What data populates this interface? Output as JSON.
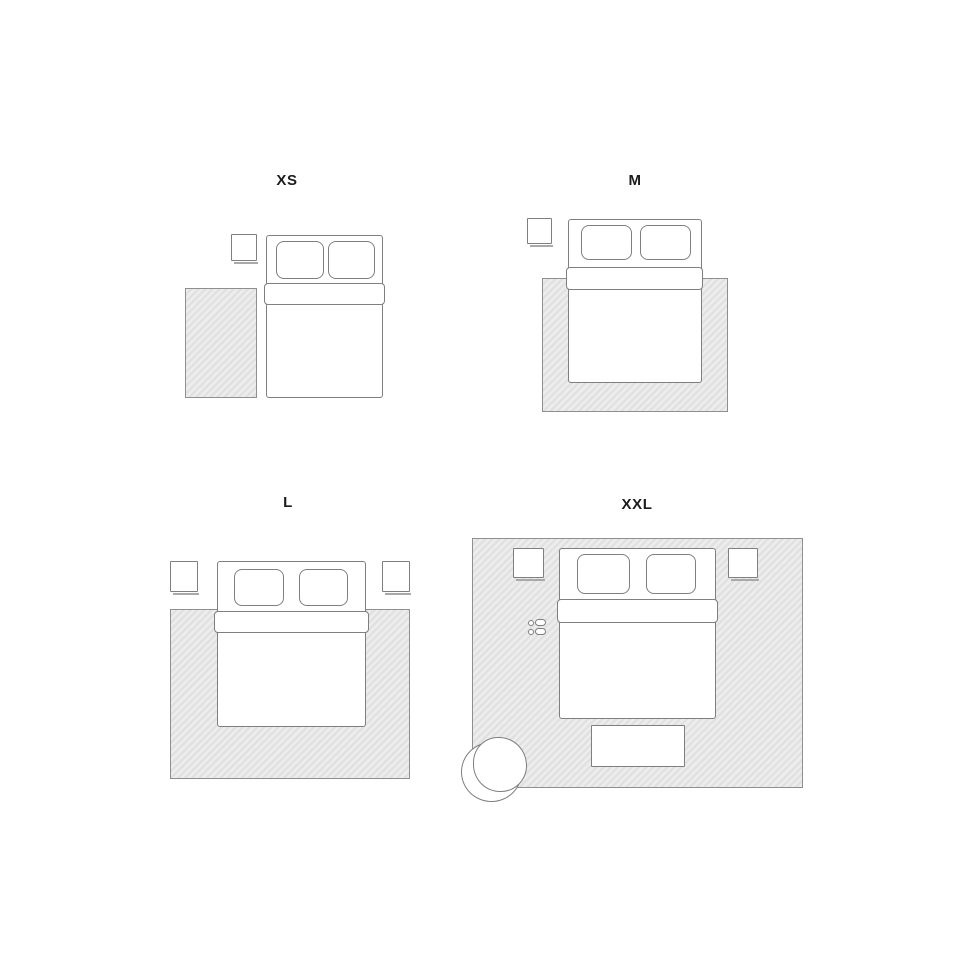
{
  "sizes": [
    {
      "id": "xs",
      "label": "XS"
    },
    {
      "id": "m",
      "label": "M"
    },
    {
      "id": "l",
      "label": "L"
    },
    {
      "id": "xxl",
      "label": "XXL"
    }
  ],
  "colors": {
    "background": "#ffffff",
    "label_text": "#1c1c1c",
    "furniture_outline": "#7f7f7f",
    "rug_fill_light": "#ededed",
    "rug_fill_dark": "#e1e1e1",
    "rug_border": "#8f8f8f"
  },
  "icons": {
    "bed": "bed-top-view",
    "pillow": "pillow",
    "duvet": "folded-duvet",
    "nightstand": "nightstand",
    "rug": "hatched-rug",
    "bench": "foot-bench",
    "slippers": "slippers",
    "armchair": "round-armchair"
  }
}
